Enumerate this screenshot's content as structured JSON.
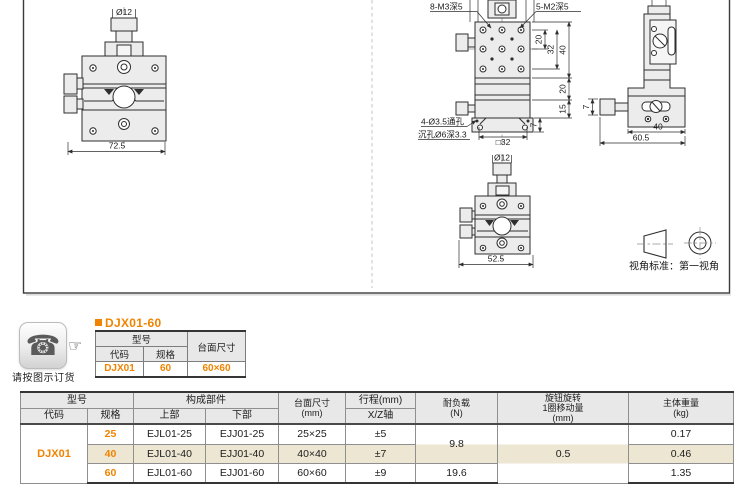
{
  "drawings": {
    "front_large": {
      "dia": "Ø12",
      "width": "72.5"
    },
    "top_view": {
      "m3": "8-M3深5",
      "m2": "5-M2深5",
      "d20a": "20",
      "d32": "32",
      "d40": "40",
      "d20b": "20",
      "d15": "15",
      "d7": "7",
      "sq32": "□32",
      "note1": "4-Ø3.5通孔",
      "note2": "沉孔Ø6深3.3"
    },
    "side_view": {
      "d7": "7",
      "d40": "40",
      "d605": "60.5"
    },
    "front_small": {
      "dia": "Ø12",
      "width": "52.5"
    },
    "projection": {
      "label": "视角标准：第一视角"
    }
  },
  "order": {
    "phone_glyph": "☎",
    "hand_glyph": "☞",
    "caption": "请按图示订货"
  },
  "example": {
    "title": "DJX01-60",
    "table": {
      "model": "型号",
      "code": "代码",
      "spec": "规格",
      "surface": "台面尺寸",
      "row": {
        "code": "DJX01",
        "spec": "60",
        "surface": "60×60"
      }
    }
  },
  "spec_table": {
    "headers": {
      "model": "型号",
      "code": "代码",
      "spec": "规格",
      "components": "构成部件",
      "upper": "上部",
      "lower": "下部",
      "surface1": "台面尺寸",
      "surface2": "(mm)",
      "travel": "行程(mm)",
      "axis": "X/Z轴",
      "load1": "耐负载",
      "load2": "(N)",
      "knob1": "旋钮旋转",
      "knob2": "1圈移动量",
      "knob3": "(mm)",
      "weight1": "主体重量",
      "weight2": "(kg)"
    },
    "code_value": "DJX01",
    "rows": [
      {
        "spec": "25",
        "upper": "EJL01-25",
        "lower": "EJJ01-25",
        "surface": "25×25",
        "travel": "±5",
        "weight": "0.17"
      },
      {
        "spec": "40",
        "upper": "EJL01-40",
        "lower": "EJJ01-40",
        "surface": "40×40",
        "travel": "±7",
        "weight": "0.46"
      },
      {
        "spec": "60",
        "upper": "EJL01-60",
        "lower": "EJJ01-60",
        "surface": "60×60",
        "travel": "±9",
        "weight": "1.35"
      }
    ],
    "load_25_40": "9.8",
    "load_60": "19.6",
    "knob_move": "0.5"
  },
  "colors": {
    "accent": "#f08300",
    "stripe": "#ece6d3",
    "header_bg": "#e8e8e8"
  }
}
